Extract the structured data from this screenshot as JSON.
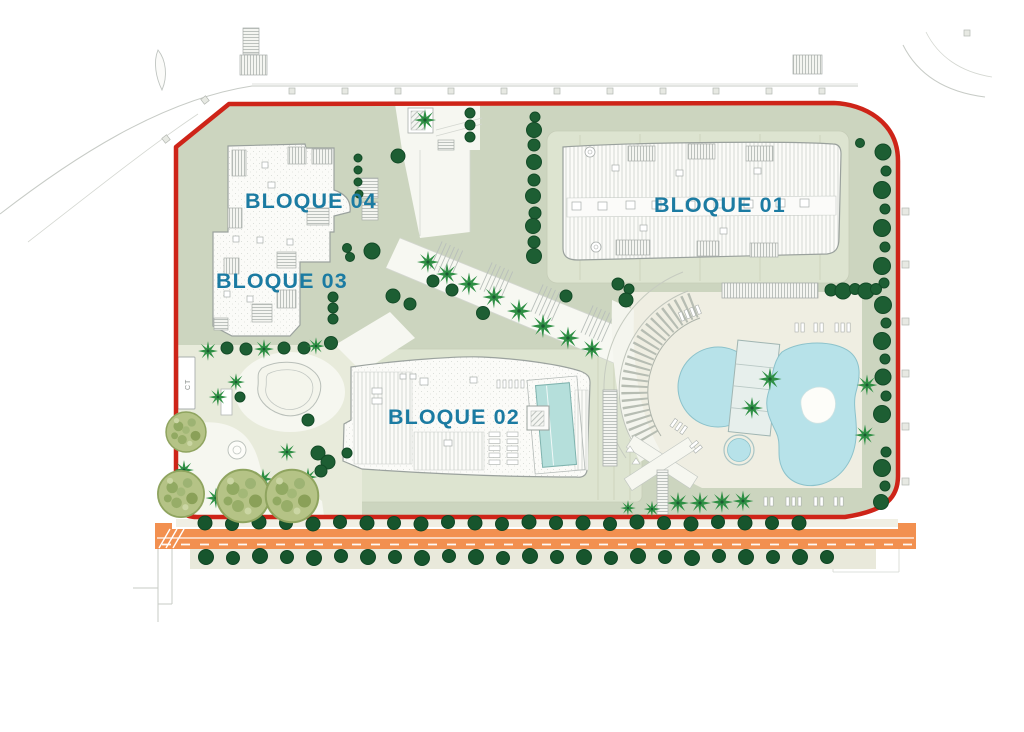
{
  "plan": {
    "blocks": [
      {
        "id": "bloque-01",
        "label": "BLOQUE 01"
      },
      {
        "id": "bloque-02",
        "label": "BLOQUE 02"
      },
      {
        "id": "bloque-03",
        "label": "BLOQUE 03"
      },
      {
        "id": "bloque-04",
        "label": "BLOQUE 04"
      }
    ],
    "utility": {
      "ct_label": "CT"
    },
    "colors": {
      "boundary_red": "#ce2418",
      "road_orange": "#f29050",
      "label_teal": "#1b7ba2",
      "landscape_sage": "#ccd5bf",
      "pad_light": "#dde4d0",
      "deck_cream": "#efeee2",
      "pool_blue": "#b7e2e9",
      "roof_pool_teal": "#b5dfdb",
      "tree_dark_green": "#1d5e33",
      "palm_green": "#2e8f44",
      "olive_tree_green": "#b5c386"
    }
  }
}
